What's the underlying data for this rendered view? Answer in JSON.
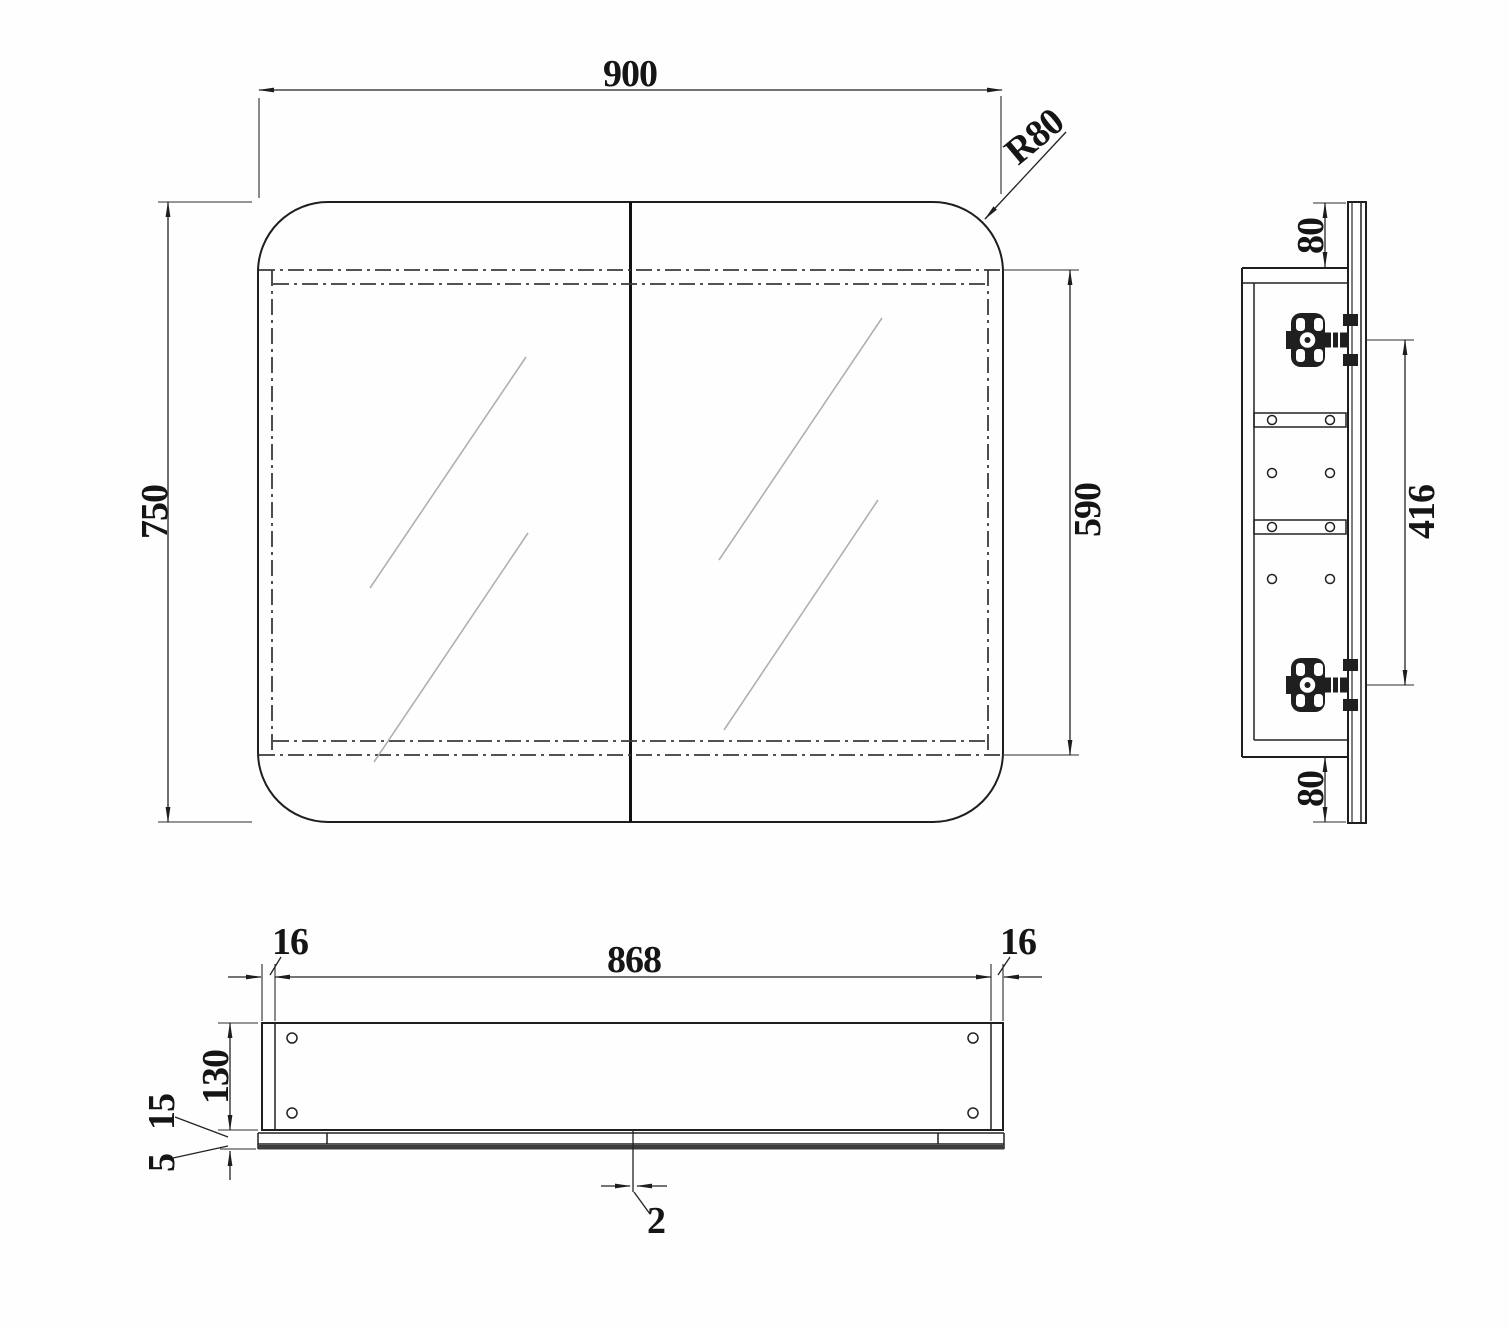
{
  "drawing": {
    "title": "mirror-cabinet-technical-drawing",
    "front_view": {
      "width_mm": "900",
      "height_mm": "750",
      "carcass_height_mm": "590",
      "corner_radius": "R80"
    },
    "side_view": {
      "top_overhang_mm": "80",
      "hinge_spacing_mm": "416",
      "bottom_overhang_mm": "80"
    },
    "bottom_view": {
      "inner_width_mm": "868",
      "left_panel_mm": "16",
      "right_panel_mm": "16",
      "depth_mm": "130",
      "door_thickness_mm": "15",
      "mirror_thickness_mm": "5",
      "door_gap_mm": "2"
    },
    "colors": {
      "line": "#1e1e1e",
      "hidden": "#3a3a3a",
      "glass": "#b0b0b0",
      "background": "#ffffff"
    }
  }
}
